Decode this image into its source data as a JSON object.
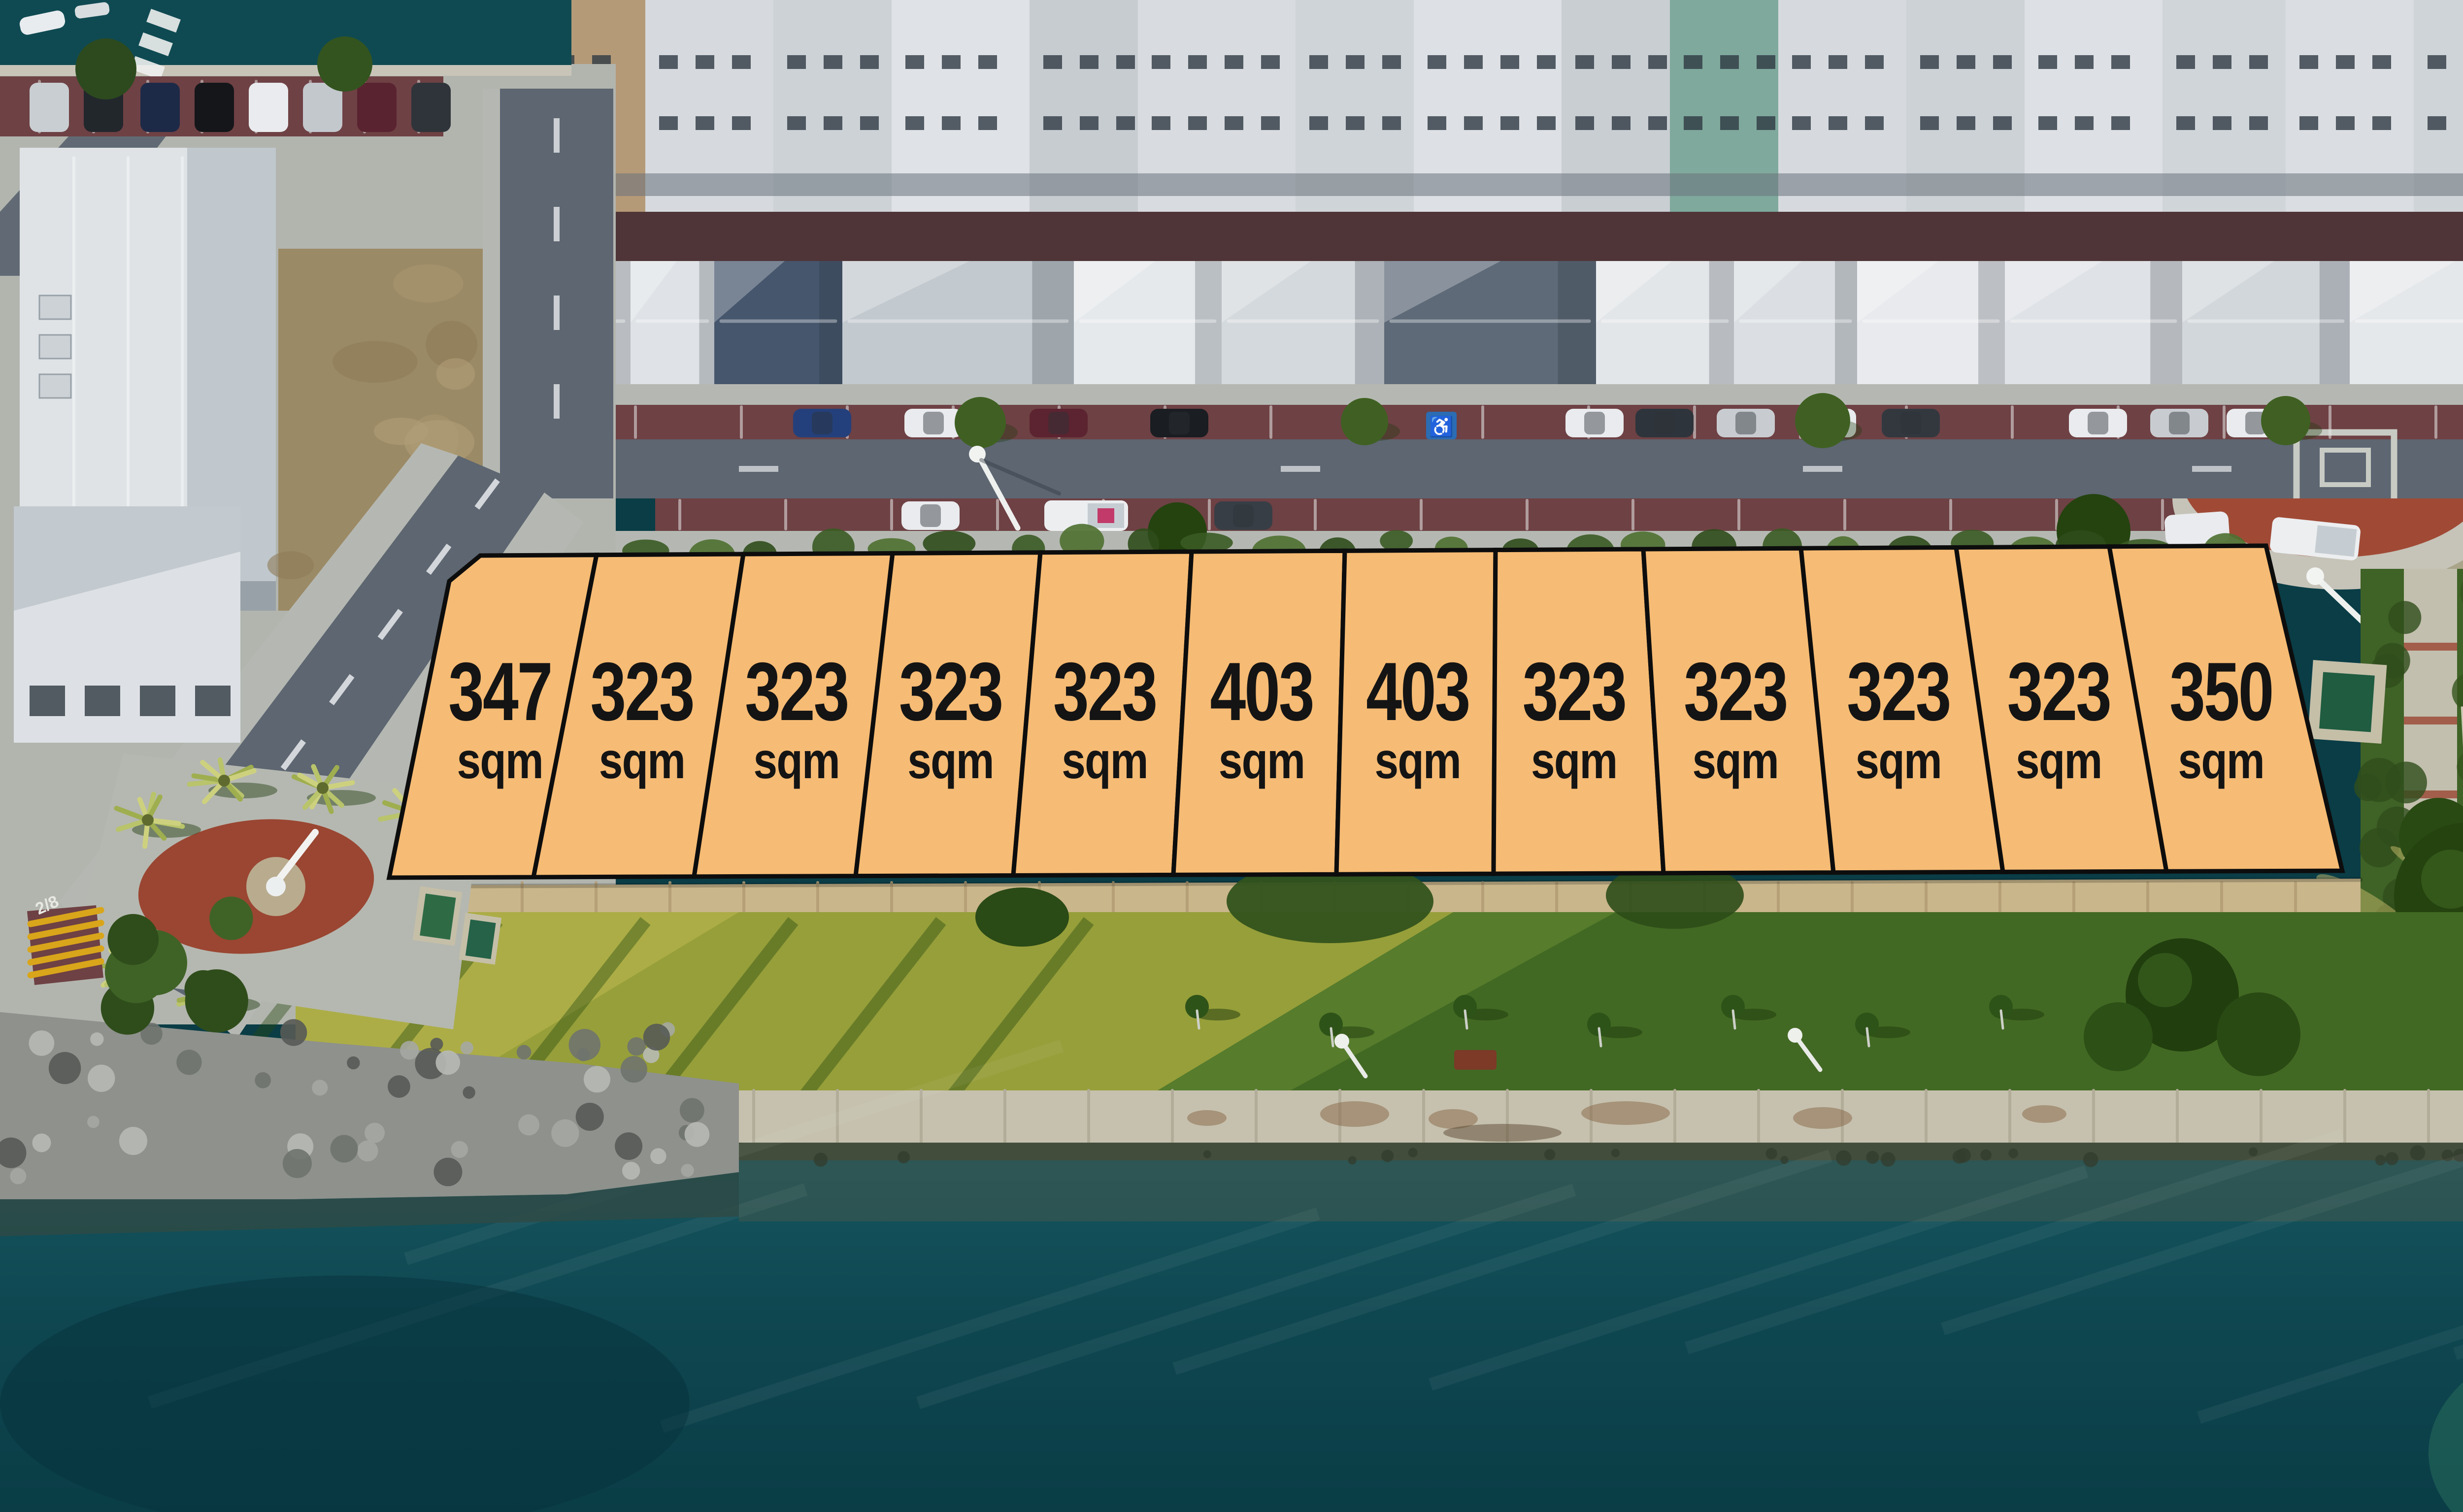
{
  "meta": {
    "description": "Aerial drone photograph of a waterfront land release: 12 surveyed lots outlined in orange between a residential street and a riverside park"
  },
  "lots": [
    {
      "id": 1,
      "area": "347",
      "unit": "sqm"
    },
    {
      "id": 2,
      "area": "323",
      "unit": "sqm"
    },
    {
      "id": 3,
      "area": "323",
      "unit": "sqm"
    },
    {
      "id": 4,
      "area": "323",
      "unit": "sqm"
    },
    {
      "id": 5,
      "area": "323",
      "unit": "sqm"
    },
    {
      "id": 6,
      "area": "403",
      "unit": "sqm"
    },
    {
      "id": 7,
      "area": "403",
      "unit": "sqm"
    },
    {
      "id": 8,
      "area": "323",
      "unit": "sqm"
    },
    {
      "id": 9,
      "area": "323",
      "unit": "sqm"
    },
    {
      "id": 10,
      "area": "323",
      "unit": "sqm"
    },
    {
      "id": 11,
      "area": "323",
      "unit": "sqm"
    },
    {
      "id": 12,
      "area": "350",
      "unit": "sqm"
    }
  ],
  "overlay": {
    "fill": "#f6bb74",
    "stroke": "#0d0d0d",
    "label_color": "#141414"
  },
  "road_markings": {
    "bay_number": "2/8",
    "accessible_parking_icon": "♿"
  },
  "palette": {
    "water": "#14525c",
    "water_deep": "#0a3d46",
    "water_shallow": "#2a6f5e",
    "asphalt": "#5d6671",
    "brick": "#6e4144",
    "concrete": "#b5b8b2",
    "promenade": "#c6c1ae",
    "seawall": "#c9b68b",
    "grass": "#567c2c",
    "grass_sunlit": "#a8a73e",
    "dry_grass": "#b3a45e",
    "hedge": "#3f6226",
    "plaza_red": "#9a4632",
    "apron_red": "#a04a36",
    "back_lane": "#4f3538",
    "dirt": "#9b8a66",
    "rocks": "#8e918c",
    "roof_white": "#e4e7ea",
    "roof_dark": "#46566c"
  }
}
